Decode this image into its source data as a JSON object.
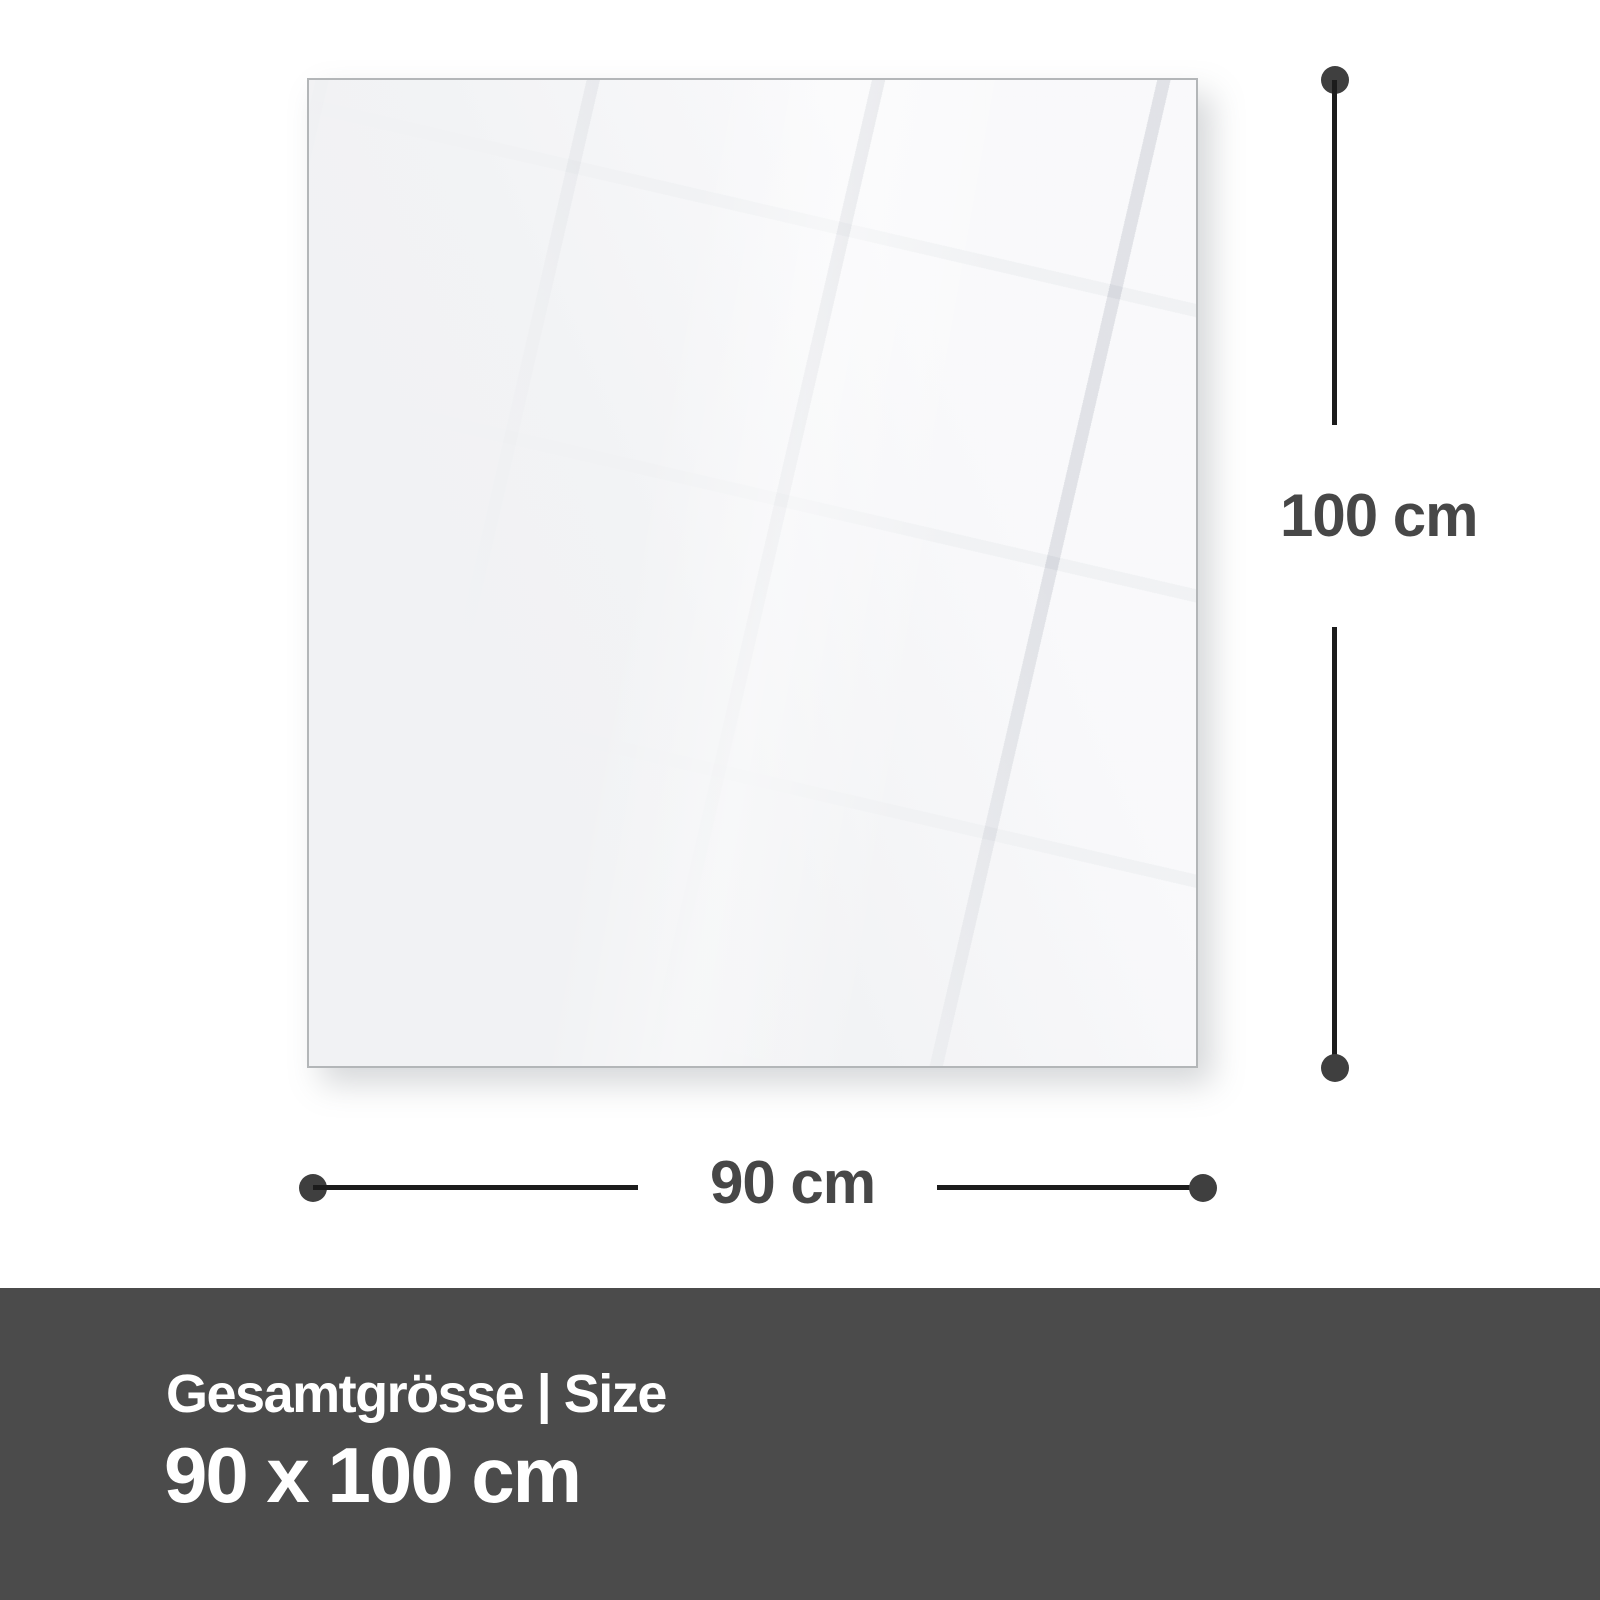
{
  "product_panel": {
    "description": "blank glossy panel preview with window reflection",
    "background_color": "#f1f2f4",
    "border_color": "#b3b6b8"
  },
  "dimensions": {
    "height_label": "100 cm",
    "width_label": "90 cm",
    "line_color": "#1c1c1c",
    "dot_color": "#3f3f3f",
    "label_color": "#474747"
  },
  "footer": {
    "title": "Gesamtgrösse | Size",
    "size_value": "90 x 100 cm",
    "background_color": "#4b4b4b",
    "text_color": "#ffffff"
  }
}
